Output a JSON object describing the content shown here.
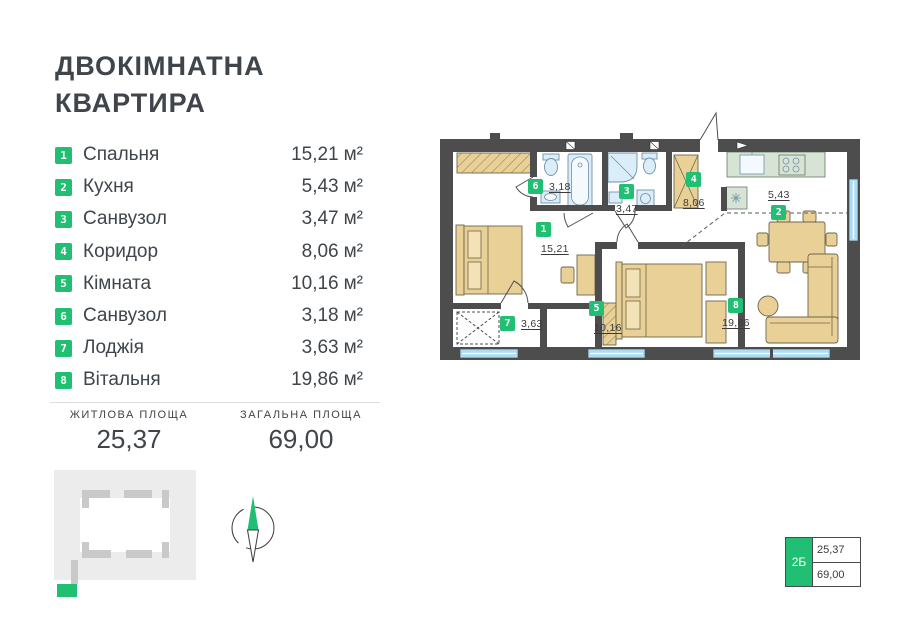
{
  "colors": {
    "accent": "#21bf73",
    "wall": "#4d4d4d",
    "window": "#aeddf3",
    "furniture": "#e9d096",
    "kitchen": "#d7e3d4",
    "fixture": "#daedf9",
    "text": "#3f454a"
  },
  "header": {
    "title_line1": "ДВОКІМНАТНА",
    "title_line2": "КВАРТИРА"
  },
  "rooms": [
    {
      "number": "1",
      "name": "Спальня",
      "area": "15,21",
      "unit": "м²"
    },
    {
      "number": "2",
      "name": "Кухня",
      "area": "5,43",
      "unit": "м²"
    },
    {
      "number": "3",
      "name": "Санвузол",
      "area": "3,47",
      "unit": "м²"
    },
    {
      "number": "4",
      "name": "Коридор",
      "area": "8,06",
      "unit": "м²"
    },
    {
      "number": "5",
      "name": "Кімната",
      "area": "10,16",
      "unit": "м²"
    },
    {
      "number": "6",
      "name": "Санвузол",
      "area": "3,18",
      "unit": "м²"
    },
    {
      "number": "7",
      "name": "Лоджія",
      "area": "3,63",
      "unit": "м²"
    },
    {
      "number": "8",
      "name": "Вітальня",
      "area": "19,86",
      "unit": "м²"
    }
  ],
  "summary": {
    "living": {
      "label": "ЖИТЛОВА ПЛОЩА",
      "value": "25,37"
    },
    "total": {
      "label": "ЗАГАЛЬНА ПЛОЩА",
      "value": "69,00"
    }
  },
  "floor_plan": {
    "labels": [
      {
        "number": "1",
        "area": "15,21"
      },
      {
        "number": "2",
        "area": "5,43"
      },
      {
        "number": "3",
        "area": "3,47"
      },
      {
        "number": "4",
        "area": "8,06"
      },
      {
        "number": "5",
        "area": "10,16"
      },
      {
        "number": "6",
        "area": "3,18"
      },
      {
        "number": "7",
        "area": "3,63"
      },
      {
        "number": "8",
        "area": "19,86"
      }
    ]
  },
  "unit_tag": {
    "label": "2Б",
    "living": "25,37",
    "total": "69,00"
  }
}
